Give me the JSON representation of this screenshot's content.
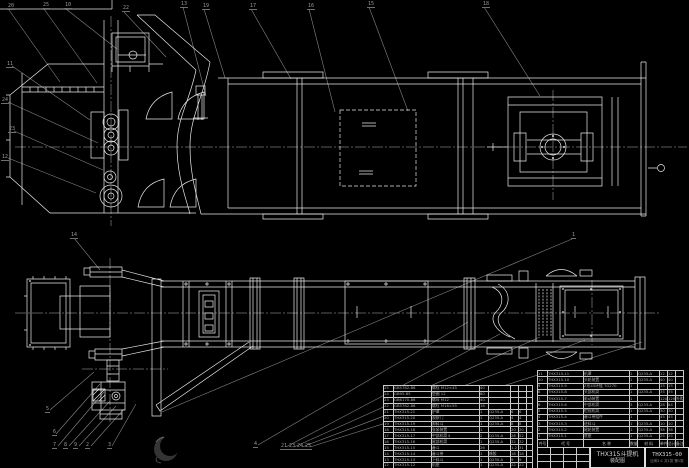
{
  "drawing": {
    "title": "THX315斗提机",
    "subtitle": "装配图",
    "drawing_no": "THX315-00",
    "sheet_info": "比例1:1 共1张 第1张"
  },
  "colors": {
    "background": "#000000",
    "line": "#e8e8e8",
    "leader": "#848484",
    "centerline": "#b5b5b5",
    "table_text": "#adadad"
  },
  "bom": {
    "header": {
      "item": "件号",
      "code": "代 号",
      "name": "名 称",
      "qty": "数量",
      "material": "材 料",
      "unit_w": "单件",
      "total_w": "总计",
      "note": "备注"
    },
    "left_rows": [
      [
        "25",
        "GB5782-86",
        "螺栓 M12×45",
        "40",
        "",
        "",
        "",
        ""
      ],
      [
        "24",
        "GB95-85",
        "垫圈 12",
        "80",
        "",
        "",
        "",
        ""
      ],
      [
        "23",
        "GB6170-86",
        "螺母 M12",
        "40",
        "",
        "",
        "",
        ""
      ],
      [
        "22",
        "GB5782-86",
        "螺栓 M16×55",
        "16",
        "",
        "",
        "",
        ""
      ],
      [
        "21",
        "THX315-21",
        "护罩",
        "1",
        "Q235-A",
        "6",
        "6",
        ""
      ],
      [
        "20",
        "THX315-20",
        "观察门",
        "1",
        "Q235-A",
        "4",
        "4",
        ""
      ],
      [
        "19",
        "THX315-19",
        "卸料斗",
        "1",
        "Q235-A",
        "8",
        "8",
        ""
      ],
      [
        "18",
        "THX315-18",
        "张紧装置",
        "1",
        "",
        "20",
        "20",
        ""
      ],
      [
        "17",
        "THX315-17",
        "中部机筒 Ⅱ",
        "2",
        "Q235-A",
        "26",
        "52",
        ""
      ],
      [
        "16",
        "THX315-16",
        "尾部机筒",
        "1",
        "Q235-A",
        "32",
        "32",
        ""
      ],
      [
        "15",
        "THX315-15",
        "畚斗",
        "26",
        "",
        "1.2",
        "31",
        ""
      ],
      [
        "14",
        "THX315-14",
        "畚斗带",
        "1",
        "橡胶",
        "18",
        "18",
        ""
      ],
      [
        "13",
        "THX315-13",
        "下料斗",
        "1",
        "Q235-A",
        "9",
        "9",
        ""
      ],
      [
        "12",
        "THX315-12",
        "机座",
        "1",
        "Q235-A",
        "22",
        "22",
        ""
      ]
    ],
    "right_rows": [
      [
        "11",
        "THX315-11",
        "机罩",
        "1",
        "Q235-A",
        "12",
        "12",
        ""
      ],
      [
        "10",
        "THX315-10",
        "头轮装置",
        "1",
        "Q235-A",
        "40",
        "40",
        ""
      ],
      [
        "9",
        "THX315-9",
        "Z形45环链 TG270",
        "1",
        "",
        "15",
        "15",
        ""
      ],
      [
        "8",
        "THX315-8",
        "头部机筒",
        "1",
        "Q235-A",
        "35",
        "35",
        ""
      ],
      [
        "7",
        "THX315-7",
        "驱动装置",
        "1",
        "",
        "120",
        "120",
        "外购"
      ],
      [
        "6",
        "THX315-6",
        "中部机筒",
        "3",
        "Q235-A",
        "28",
        "84",
        ""
      ],
      [
        "5",
        "THX315-5",
        "检视机筒",
        "1",
        "Q235-A",
        "30",
        "30",
        ""
      ],
      [
        "4",
        "THX315-4",
        "畚斗带组件",
        "1",
        "",
        "45",
        "45",
        ""
      ],
      [
        "3",
        "THX315-3",
        "进料斗",
        "1",
        "Q235-A",
        "10",
        "10",
        ""
      ],
      [
        "2",
        "THX315-2",
        "尾轮装置",
        "1",
        "Q235-A",
        "38",
        "38",
        ""
      ],
      [
        "1",
        "THX315-1",
        "底座",
        "1",
        "Q235-A",
        "25",
        "25",
        ""
      ]
    ]
  },
  "callouts": [
    {
      "n": "20",
      "x": 7,
      "y": 4
    },
    {
      "n": "25",
      "x": 42,
      "y": 3
    },
    {
      "n": "10",
      "x": 64,
      "y": 3
    },
    {
      "n": "22",
      "x": 122,
      "y": 6
    },
    {
      "n": "13",
      "x": 180,
      "y": 2
    },
    {
      "n": "19",
      "x": 202,
      "y": 4
    },
    {
      "n": "17",
      "x": 249,
      "y": 4
    },
    {
      "n": "16",
      "x": 307,
      "y": 4
    },
    {
      "n": "15",
      "x": 367,
      "y": 2
    },
    {
      "n": "18",
      "x": 482,
      "y": 2
    },
    {
      "n": "11",
      "x": 6,
      "y": 62
    },
    {
      "n": "24",
      "x": 1,
      "y": 98
    },
    {
      "n": "23",
      "x": 8,
      "y": 127
    },
    {
      "n": "12",
      "x": 1,
      "y": 155
    },
    {
      "n": "14",
      "x": 70,
      "y": 233
    },
    {
      "n": "1",
      "x": 571,
      "y": 233
    },
    {
      "n": "5",
      "x": 45,
      "y": 407
    },
    {
      "n": "6",
      "x": 52,
      "y": 430
    },
    {
      "n": "7",
      "x": 52,
      "y": 443
    },
    {
      "n": "8",
      "x": 63,
      "y": 443
    },
    {
      "n": "9",
      "x": 73,
      "y": 443
    },
    {
      "n": "2",
      "x": 85,
      "y": 443
    },
    {
      "n": "3",
      "x": 107,
      "y": 443
    },
    {
      "n": "4",
      "x": 253,
      "y": 442
    },
    {
      "n": "21",
      "x": 280,
      "y": 444
    },
    {
      "n": "23",
      "x": 288,
      "y": 444
    },
    {
      "n": "24",
      "x": 296,
      "y": 444
    },
    {
      "n": "25",
      "x": 304,
      "y": 444
    }
  ]
}
